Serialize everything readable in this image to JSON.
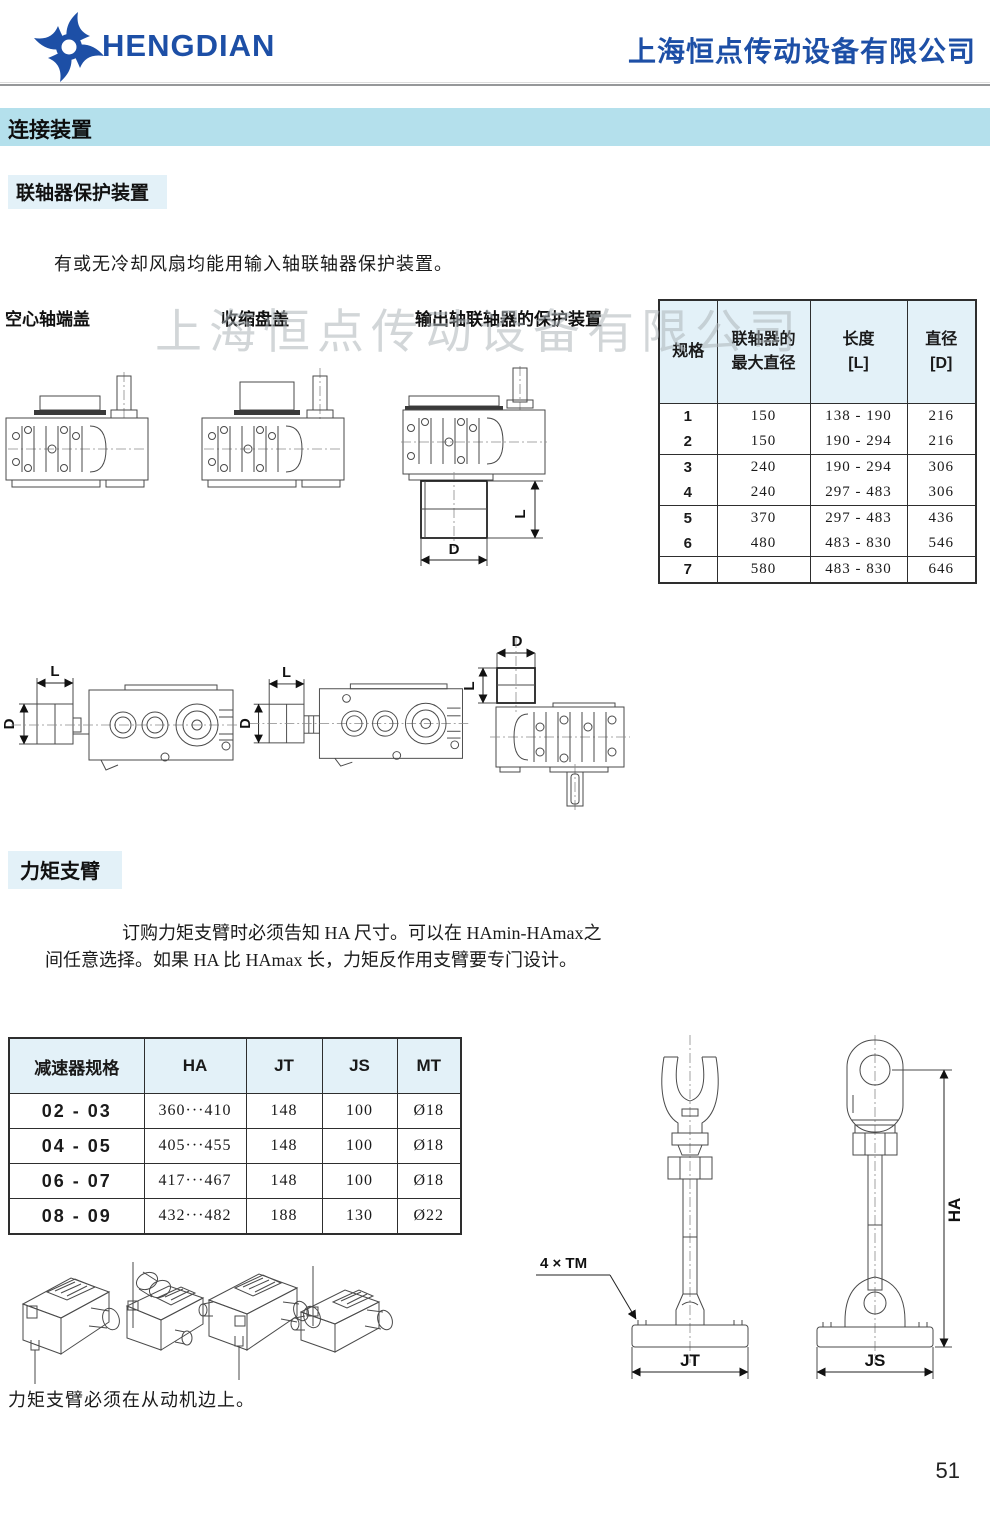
{
  "header": {
    "brand": "HENGDIAN",
    "company": "上海恒点传动设备有限公司"
  },
  "banner": {
    "title": "连接装置"
  },
  "coupling_section": {
    "title": "联轴器保护装置",
    "intro": "有或无冷却风扇均能用输入轴联轴器保护装置。",
    "figure_labels": {
      "hollow_shaft_cover": "空心轴端盖",
      "shrink_disk_cover": "收缩盘盖",
      "output_guard": "输出轴联轴器的保护装置"
    },
    "table": {
      "headers": [
        "规格",
        "联轴器的\n最大直径",
        "长度\n[L]",
        "直径\n[D]"
      ],
      "rows": [
        [
          "1",
          "150",
          "138 - 190",
          "216"
        ],
        [
          "2",
          "150",
          "190 - 294",
          "216"
        ],
        [
          "3",
          "240",
          "190 - 294",
          "306"
        ],
        [
          "4",
          "240",
          "297 - 483",
          "306"
        ],
        [
          "5",
          "370",
          "297 - 483",
          "436"
        ],
        [
          "6",
          "480",
          "483 - 830",
          "546"
        ],
        [
          "7",
          "580",
          "483 - 830",
          "646"
        ]
      ]
    }
  },
  "torque_section": {
    "title": "力矩支臂",
    "intro_line1": "订购力矩支臂时必须告知 HA 尺寸。可以在 HAmin-HAmax之",
    "intro_line2": "间任意选择。如果 HA 比 HAmax  长，力矩反作用支臂要专门设计。",
    "table": {
      "headers": [
        "减速器规格",
        "HA",
        "JT",
        "JS",
        "MT"
      ],
      "rows": [
        [
          "02 - 03",
          "360···410",
          "148",
          "100",
          "Ø18"
        ],
        [
          "04 - 05",
          "405···455",
          "148",
          "100",
          "Ø18"
        ],
        [
          "06 - 07",
          "417···467",
          "148",
          "100",
          "Ø18"
        ],
        [
          "08 - 09",
          "432···482",
          "188",
          "130",
          "Ø22"
        ]
      ]
    },
    "note": "力矩支臂必须在从动机边上。",
    "labels": {
      "tm": "4 × TM",
      "jt": "JT",
      "js": "JS",
      "ha": "HA"
    }
  },
  "dims": {
    "L": "L",
    "D": "D"
  },
  "watermark": "上海恒点传动设备有限公司",
  "page_number": "51",
  "colors": {
    "accent_blue": "#1d4fa6",
    "band_blue": "#b4e0ec",
    "table_header_blue": "#e3f1f8"
  }
}
